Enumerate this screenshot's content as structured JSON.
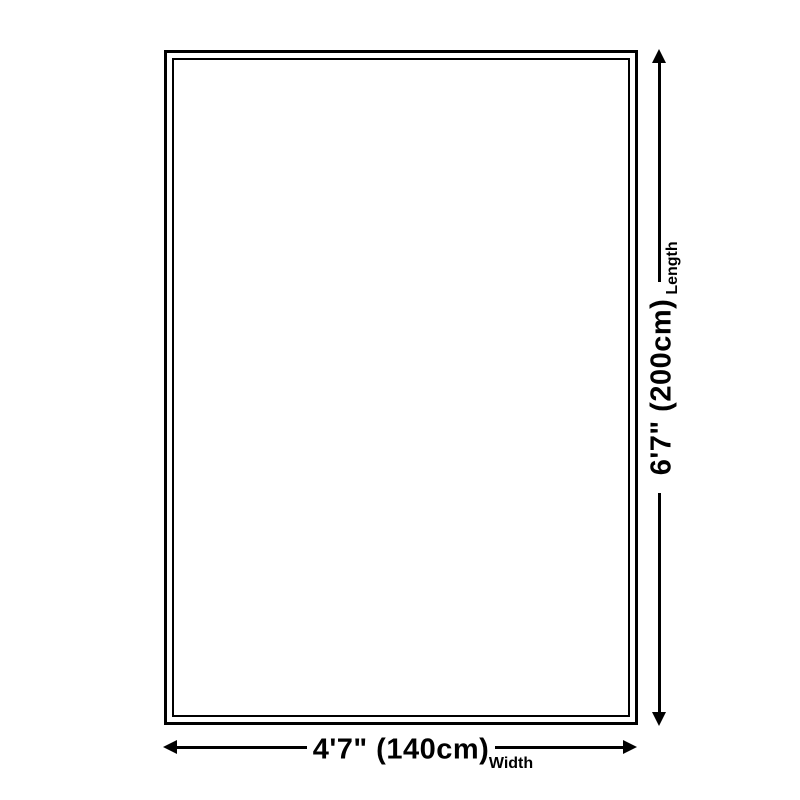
{
  "diagram": {
    "type": "product-dimension-diagram",
    "shape": "rectangle",
    "background_color": "#ffffff",
    "line_color": "#000000",
    "length": {
      "value": "6'7\" (200cm)",
      "label": "Length"
    },
    "width": {
      "value": "4'7\" (140cm)",
      "label": "Width"
    }
  }
}
